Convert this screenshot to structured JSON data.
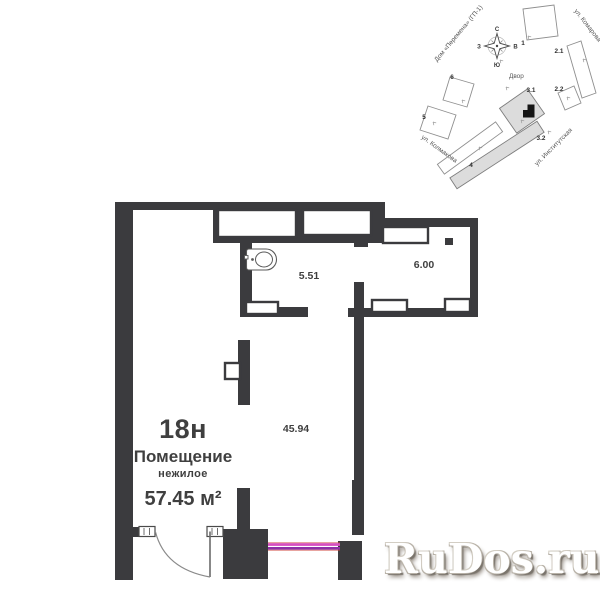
{
  "floorplan": {
    "unit_number": "18н",
    "premise_type": "Помещение",
    "premise_subtype": "нежилое",
    "total_area": "57.45 м²",
    "rooms": [
      {
        "area": "5.51",
        "x": 309,
        "y": 279
      },
      {
        "area": "6.00",
        "x": 424,
        "y": 268
      },
      {
        "area": "45.94",
        "x": 296,
        "y": 432
      }
    ]
  },
  "site_plan": {
    "courtyard_label": "Двор",
    "house_label": "Дом «Перемена» (ГП-1)",
    "streets": [
      "ул. Комарова",
      "ул. Колмакова",
      "ул. Институтская"
    ],
    "buildings": [
      {
        "text": "1",
        "x": 523,
        "y": 45
      },
      {
        "text": "2.1",
        "x": 559,
        "y": 53
      },
      {
        "text": "2.2",
        "x": 559,
        "y": 91
      },
      {
        "text": "3.1",
        "x": 531,
        "y": 92
      },
      {
        "text": "3.2",
        "x": 541,
        "y": 140
      },
      {
        "text": "4",
        "x": 471,
        "y": 167
      },
      {
        "text": "5",
        "x": 424,
        "y": 119
      },
      {
        "text": "6",
        "x": 452,
        "y": 79
      }
    ],
    "compass": {
      "north": "С",
      "south": "Ю",
      "west": "З",
      "east": "В"
    }
  },
  "watermark": {
    "text": "RuDos.ru"
  },
  "colors": {
    "wall": "#3b3b3e",
    "plan_text": "#3f3f3f",
    "site_outline": "#8f8f8f",
    "site_gray_fill": "#dcdcdc",
    "accent_magenta": "#d64fc0",
    "accent_purple": "#8e2fa6",
    "accent_red": "#cf4238"
  },
  "geometry": {
    "walls": [
      [
        115,
        202,
        260,
        8
      ],
      [
        115,
        202,
        18,
        378
      ],
      [
        366,
        202,
        19,
        41
      ],
      [
        354,
        233,
        14,
        14
      ],
      [
        378,
        218,
        100,
        9
      ],
      [
        470,
        218,
        8,
        99
      ],
      [
        213,
        208,
        165,
        35
      ],
      [
        240,
        240,
        12,
        77
      ],
      [
        240,
        307,
        68,
        10
      ],
      [
        348,
        308,
        130,
        9
      ],
      [
        354,
        282,
        10,
        253
      ],
      [
        238,
        340,
        12,
        65
      ],
      [
        237,
        488,
        13,
        42
      ],
      [
        223,
        529,
        45,
        50
      ],
      [
        352,
        480,
        11,
        55
      ],
      [
        338,
        541,
        24,
        39
      ],
      [
        130,
        527,
        11,
        10
      ],
      [
        445,
        238,
        8,
        7
      ]
    ],
    "niches": [
      [
        218,
        210,
        78,
        27
      ],
      [
        303,
        210,
        68,
        25
      ],
      [
        383,
        227,
        45,
        16
      ],
      [
        246,
        302,
        32,
        12
      ],
      [
        372,
        300,
        35,
        12
      ],
      [
        445,
        299,
        25,
        13
      ],
      [
        225,
        363,
        15,
        16
      ]
    ],
    "jambs": [
      [
        139,
        526.5,
        16,
        10
      ],
      [
        207,
        526.5,
        16,
        10
      ]
    ],
    "door": {
      "leaf": [
        210,
        531.5,
        210,
        577
      ],
      "arc": "M155.5 532 Q165 569 210 577"
    },
    "showcase_lines": [
      {
        "x": 268,
        "y": 542.2,
        "w": 72,
        "h": 1.1,
        "fill": "#cf4238",
        "opacity": 0.6
      },
      {
        "x": 268,
        "y": 543.2,
        "w": 72,
        "h": 2.7,
        "fill": "#d64fc0",
        "opacity": 1
      },
      {
        "x": 268,
        "y": 547.0,
        "w": 72,
        "h": 2.7,
        "fill": "#8e2fa6",
        "opacity": 1
      },
      {
        "x": 268,
        "y": 549.7,
        "w": 72,
        "h": 1.1,
        "fill": "#cf4238",
        "opacity": 0.6
      }
    ],
    "site_buildings": [
      {
        "points": "523,9 554,5 558,36 527,40",
        "gray": false
      },
      {
        "points": "567,46 581,41 596,93 582,98",
        "gray": false
      },
      {
        "points": "558,93 574,86 581,103 565,110",
        "gray": false
      },
      {
        "points": "450,77 474,84 467,107 443,100",
        "gray": false
      },
      {
        "points": "428,106 456,115 448,139 420,130",
        "gray": false
      },
      {
        "points": "437.4,164.4 495.6,121.9 502.6,131.7 444.4,174.1",
        "gray": false
      },
      {
        "points": "537,121.3 544.1,132.2 457,188.8 449.9,177.9",
        "gray": true
      },
      {
        "points": "527.3,89 544.5,113.6 516.7,133.1 499.5,108.4",
        "gray": true
      }
    ],
    "site_ticks": [
      [
        528,
        36
      ],
      [
        583,
        59
      ],
      [
        567,
        97
      ],
      [
        506,
        87
      ],
      [
        462,
        100
      ],
      [
        433,
        122
      ],
      [
        521,
        120
      ],
      [
        548,
        131
      ],
      [
        479,
        147
      ],
      [
        500,
        60
      ]
    ],
    "unit_marker_path": "M523 110 L527.5 110 L527.5 104.5 L534.5 104.5 L534.5 117.5 L523 117.5 Z"
  }
}
